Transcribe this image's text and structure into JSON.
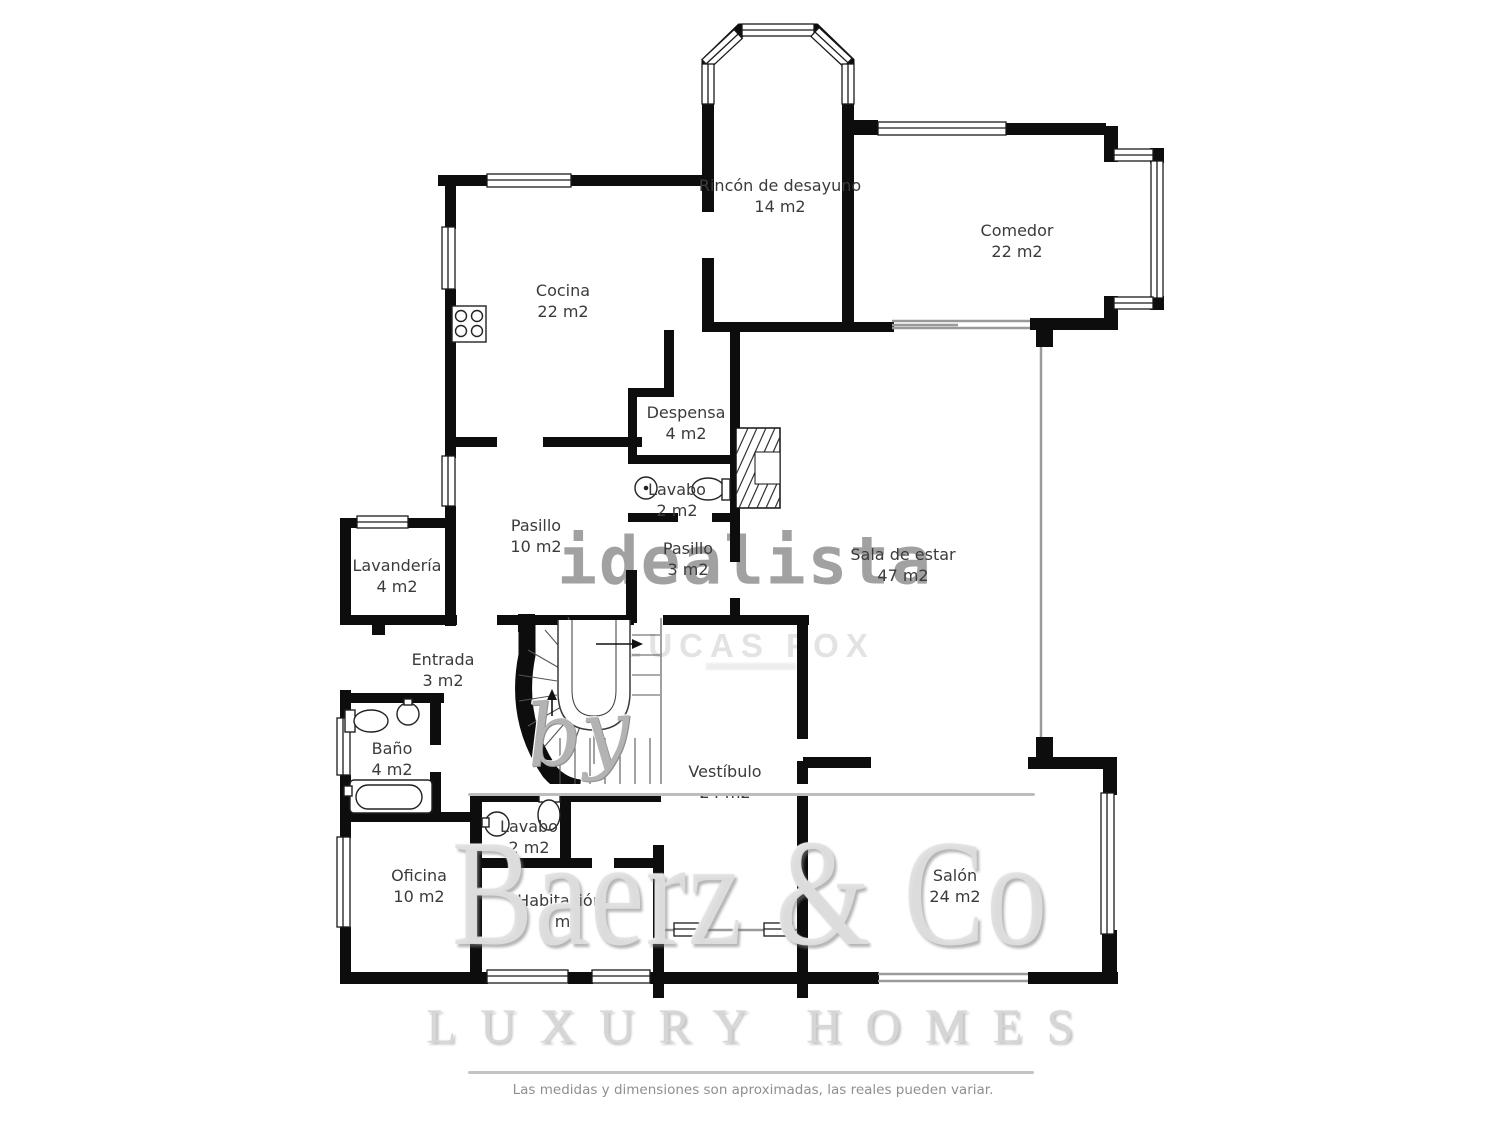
{
  "page": {
    "type": "floor-plan"
  },
  "rooms": [
    {
      "name": "Rincón de desayuno",
      "area": "14 m2"
    },
    {
      "name": "Comedor",
      "area": "22 m2"
    },
    {
      "name": "Cocina",
      "area": "22 m2"
    },
    {
      "name": "Despensa",
      "area": "4 m2"
    },
    {
      "name": "Lavabo",
      "area": "2 m2"
    },
    {
      "name": "Pasillo",
      "area": "10 m2"
    },
    {
      "name": "Pasillo",
      "area": "3 m2"
    },
    {
      "name": "Sala de estar",
      "area": "47 m2"
    },
    {
      "name": "Lavandería",
      "area": "4 m2"
    },
    {
      "name": "Entrada",
      "area": "3 m2"
    },
    {
      "name": "Baño",
      "area": "4 m2"
    },
    {
      "name": "Vestíbulo",
      "area": "24 m2"
    },
    {
      "name": "Lavabo",
      "area": "2 m2"
    },
    {
      "name": "Oficina",
      "area": "10 m2"
    },
    {
      "name": "Habitación",
      "area": "9 m2"
    },
    {
      "name": "Salón",
      "area": "24 m2"
    }
  ],
  "watermarks": {
    "portal": "idealista",
    "agency": "LUCAS FOX",
    "script": "by",
    "brand": "Baerz & Co",
    "tagline": "LUXURY HOMES"
  },
  "disclaimer": "Las medidas y dimensiones son aproximadas, las reales pueden variar.",
  "colors": {
    "wall": "#0d0d0d",
    "label": "#3b3b3b",
    "watermark_gray": "#9c9c9c",
    "watermark_light": "#dedede"
  }
}
